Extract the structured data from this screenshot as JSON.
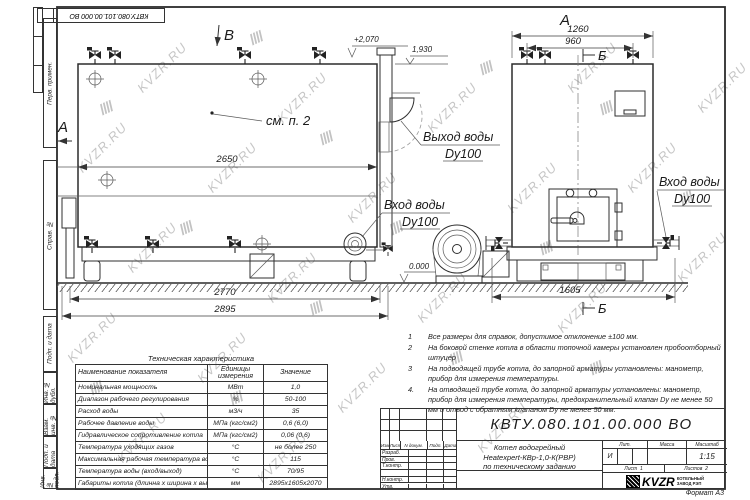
{
  "sheet": {
    "stamp_top": "КВТУ.080.101.00.000  ВО",
    "format_label": "Формат  А3",
    "margin_labels": [
      "Перв. примен.",
      "Справ. №",
      "Подп. и дата",
      "Инв. № дубл.",
      "Взам. инв. №",
      "Подп. и дата",
      "Инв. № подл."
    ]
  },
  "watermark": {
    "text": "KVZR.RU",
    "glyph": "////"
  },
  "drawing": {
    "side_view": {
      "section_a": "А",
      "section_b": "В",
      "dim_inner": "2650",
      "dim_mid": "2770",
      "dim_overall": "2895",
      "elev_top": "+2,070",
      "elev_shelf": "1,930",
      "elev_zero": "0.000",
      "see_note": "см. п. 2",
      "outlet_label": "Выход воды",
      "outlet_dn": "Dy100",
      "inlet_label": "Вход воды",
      "inlet_dn": "Dy100"
    },
    "front_view": {
      "view_label": "А",
      "section_top": "Б",
      "section_bottom": "Б",
      "dim_overall": "1260",
      "dim_inner": "960",
      "dim_depth": "1605",
      "inlet_label": "Вход воды",
      "inlet_dn": "Dy100"
    }
  },
  "notes": {
    "items": [
      {
        "num": "1",
        "text": "Все размеры для справок, допустимое отклонение  ±100 мм."
      },
      {
        "num": "2",
        "text": "На боковой стенке котла в области топочной камеры установлен пробоотборный штуцер"
      },
      {
        "num": "3",
        "text": "На  подводящей трубе котла, до запорной арматуры установлены: манометр, прибор для измерения температуры."
      },
      {
        "num": "4.",
        "text": "На отводящей трубе котла, до запорной арматуры установлены: манометр, прибор для измерения температуры, предохранительный клапан Dу не менее 50 мм и отвод с обратным клапаном Dу не менее 50 мм."
      }
    ]
  },
  "tech_table": {
    "title": "Техническая характеристика",
    "col_headers": [
      "Наименование показателя",
      "Единицы измерения",
      "Значение"
    ],
    "rows": [
      [
        "Номинальная мощность",
        "МВт",
        "1,0"
      ],
      [
        "Диапазон рабочего регулирования",
        "%",
        "50-100"
      ],
      [
        "Расход воды",
        "м3/ч",
        "35"
      ],
      [
        "Рабочее давление воды",
        "МПа (кгс/см2)",
        "0,6 (6,0)"
      ],
      [
        "Гидравлическое сопротивление котла",
        "МПа (кгс/см2)",
        "0,06 (0,6)"
      ],
      [
        "Температура уходящих газов",
        "°С",
        "не более 250"
      ],
      [
        "Максимальная рабочая температура воды",
        "°С",
        "115"
      ],
      [
        "Температура воды (вход/выход)",
        "°С",
        "70/95"
      ],
      [
        "Габариты котла (длинна х ширина х высота)",
        "мм",
        "2895х1605х2070"
      ]
    ]
  },
  "title_block": {
    "doc_number": "КВТУ.080.101.00.000  ВО",
    "change_headers": [
      "Изм",
      "Лист",
      "N докум.",
      "Подп.",
      "Дата"
    ],
    "roles": [
      "Разраб.",
      "Пров.",
      "Т.контр.",
      "",
      "Н.контр.",
      "Утв."
    ],
    "product_lines": [
      "Котел водогрейный",
      "Heatexpert-КВр-1,0-К(РВР)",
      "по техническому заданию"
    ],
    "lit_header": "Лит.",
    "lit_value": "И",
    "mass_header": "Масса",
    "scale_header": "Масштаб",
    "scale_value": "1:15",
    "sheet_label": "Лист",
    "sheet_value": "1",
    "sheets_label": "Листов",
    "sheets_value": "2",
    "brand": "KVZR",
    "brand_lines": [
      "КОТЕЛЬНЫЙ",
      "ЗАВОД РЭП"
    ]
  }
}
